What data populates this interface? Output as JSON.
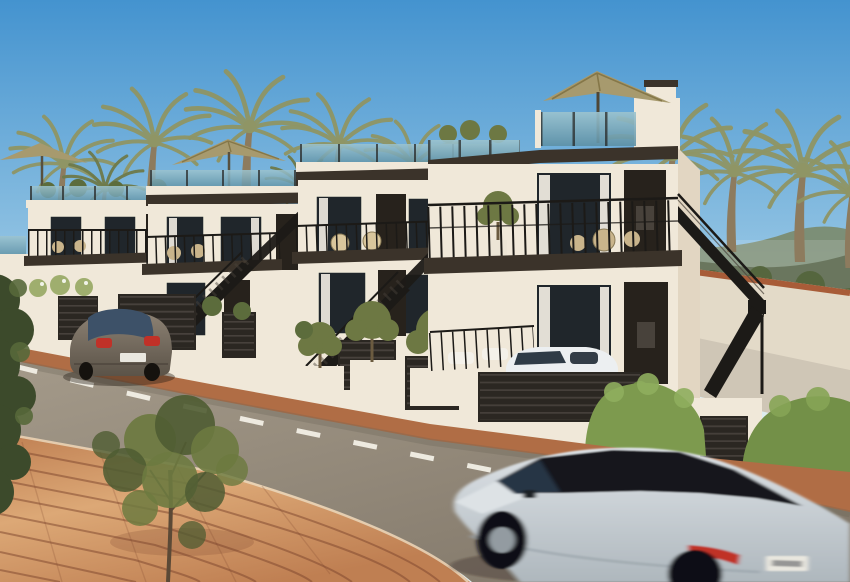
{
  "scene": {
    "type": "exterior architectural rendering",
    "setting": "row of modern white townhouses with rooftop terraces on a curved street, palm trees behind, mountains at right horizon",
    "objects": {
      "townhouse_count": 4,
      "rooftop_parasols": 3,
      "parked_car": "grey hatchback at kerb",
      "moving_car": "white SUV with black roof, motion-blurred, foreground right",
      "small_car": "white city car behind louvred gate of nearest house",
      "street_marking": "white dashed centre line",
      "foreground": "orange brick paving and leafy tree, dark bush at left edge",
      "right_side": "bright trimmed hedges and terracotta-capped wall"
    }
  },
  "colors": {
    "sky_top": "#4493cf",
    "sky_mid": "#8ec1e2",
    "sky_horizon": "#dcebee",
    "mountain_far": "#7a8a6b",
    "mountain_near": "#4e5c40",
    "bg_green": "#55663e",
    "palm_foliage": "#8f9565",
    "palm_foliage_dark": "#6e7a4a",
    "palm_trunk": "#8d7b5e",
    "wall_lit": "#f0e8d9",
    "wall_mid": "#e2d6c2",
    "fascia": "#3b332a",
    "glass_light": "#9dc4cf",
    "glass_dark": "#5d90a5",
    "railing": "#1c1a17",
    "window_glass": "#20262b",
    "curtain": "#f3eee4",
    "door": "#27221c",
    "umbrella": "#a79a6e",
    "umbrella_shade": "#857748",
    "garage_slats": "#2b2722",
    "slat_accent": "#57504a",
    "shrub": "#5c6c3c",
    "flower_bush": "#9fae6e",
    "hedge": "#7d9a4e",
    "hedge_dark": "#739048",
    "olive_tree": "#6d7843",
    "road_light": "#a49a8a",
    "road_dark": "#7e7466",
    "lane_marking": "#f2efe6",
    "brick_light": "#dca876",
    "brick_dark": "#bf7f52",
    "brick_joint": "#7d452d",
    "curb_brick": "#b06d45",
    "wall_cap_terracotta": "#a85c38",
    "walkway": "#cfc6b6",
    "gray_car_hi": "#8d8274",
    "gray_car_lo": "#5b5348",
    "gray_car_glass": "#3d5168",
    "taillight": "#c03128",
    "suv_hi": "#dde2e6",
    "suv_lo": "#aeb7bd",
    "suv_glass": "#15171b",
    "alloy": "#939ba1",
    "plate": "#e9e7df",
    "tree_leaf": "#6d7a40",
    "tree_leaf_dark": "#4f5c32",
    "tree_trunk": "#5b4936",
    "bush_dark": "#3c4a2b"
  }
}
